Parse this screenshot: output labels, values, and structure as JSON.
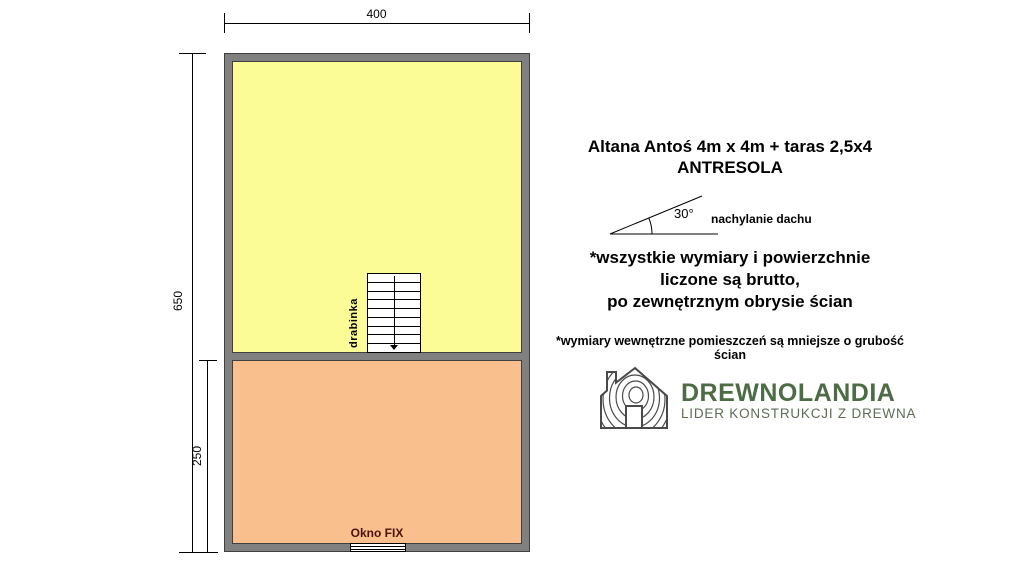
{
  "plan": {
    "dim_width": "400",
    "dim_height_total": "650",
    "dim_height_lower": "250",
    "ladder_label": "drabinka",
    "window_label": "Okno FIX"
  },
  "info": {
    "title_line1": "Altana Antoś 4m x 4m + taras 2,5x4",
    "title_line2": "ANTRESOLA",
    "roof_angle": "30°",
    "roof_label": "nachylanie dachu",
    "note_lines": [
      "*wszystkie wymiary i powierzchnie",
      "liczone są brutto,",
      "po zewnętrznym obrysie ścian"
    ],
    "footnote": "*wymiary wewnętrzne pomieszczeń są mniejsze o grubość ścian",
    "logo": {
      "name": "DREWNOLANDIA",
      "tagline": "LIDER KONSTRUKCJI Z DREWNA"
    }
  },
  "colors": {
    "room_upper": "#FCFC97",
    "room_lower": "#F9C08D",
    "wall": "#808080",
    "wall_outline": "#3F3F3F",
    "window_label": "#4A1208",
    "logo_green": "#4D6B44",
    "logo_tagline_green": "#5C6E53",
    "logo_icon": "#4A4A4A"
  }
}
